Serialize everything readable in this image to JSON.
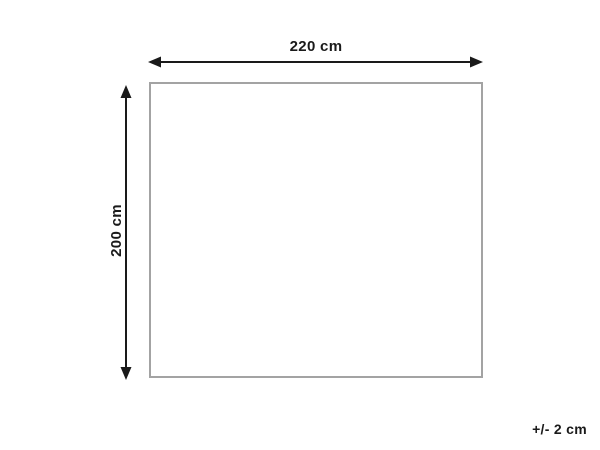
{
  "diagram": {
    "type": "product-dimension-diagram",
    "width_label": "220 cm",
    "height_label": "200 cm",
    "tolerance_label": "+/- 2 cm",
    "shape": "rectangle",
    "colors": {
      "background": "#ffffff",
      "rectangle_border": "#a3a3a3",
      "arrow": "#1a1a1a",
      "text": "#1a1a1a"
    }
  }
}
